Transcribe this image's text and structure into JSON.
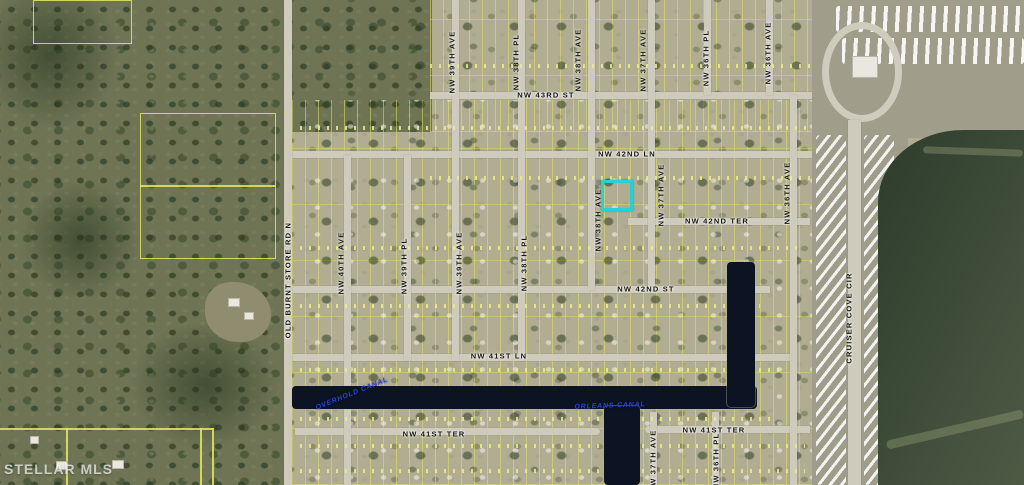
{
  "map": {
    "watermark": "STELLAR MLS",
    "highlighted_parcel": {
      "x": 601,
      "y": 180,
      "w": 32,
      "h": 31,
      "color": "#2bd0d6"
    },
    "labels": [
      {
        "text": "NW 43RD ST",
        "x": 546,
        "y": 95,
        "rot": 0,
        "kind": "street"
      },
      {
        "text": "NW 42ND LN",
        "x": 627,
        "y": 154,
        "rot": 0,
        "kind": "street"
      },
      {
        "text": "NW 42ND TER",
        "x": 717,
        "y": 221,
        "rot": 0,
        "kind": "street"
      },
      {
        "text": "NW 42ND ST",
        "x": 646,
        "y": 289,
        "rot": 0,
        "kind": "street"
      },
      {
        "text": "NW 41ST LN",
        "x": 499,
        "y": 356,
        "rot": 0,
        "kind": "street"
      },
      {
        "text": "NW 41ST TER",
        "x": 434,
        "y": 434,
        "rot": 0,
        "kind": "street"
      },
      {
        "text": "NW 41ST TER",
        "x": 714,
        "y": 430,
        "rot": 0,
        "kind": "street"
      },
      {
        "text": "OLD BURNT STORE RD N",
        "x": 288,
        "y": 280,
        "rot": -90,
        "kind": "street"
      },
      {
        "text": "NW 40TH AVE",
        "x": 341,
        "y": 263,
        "rot": -90,
        "kind": "street"
      },
      {
        "text": "NW 39TH PL",
        "x": 404,
        "y": 266,
        "rot": -90,
        "kind": "street"
      },
      {
        "text": "NW 39TH AVE",
        "x": 452,
        "y": 62,
        "rot": -90,
        "kind": "street"
      },
      {
        "text": "NW 39TH AVE",
        "x": 459,
        "y": 263,
        "rot": -90,
        "kind": "street"
      },
      {
        "text": "NW 38TH PL",
        "x": 516,
        "y": 62,
        "rot": -90,
        "kind": "street"
      },
      {
        "text": "NW 38TH PL",
        "x": 524,
        "y": 263,
        "rot": -90,
        "kind": "street"
      },
      {
        "text": "NW 38TH AVE",
        "x": 578,
        "y": 60,
        "rot": -90,
        "kind": "street"
      },
      {
        "text": "NW 38TH AVE",
        "x": 598,
        "y": 220,
        "rot": -90,
        "kind": "street"
      },
      {
        "text": "NW 37TH AVE",
        "x": 643,
        "y": 60,
        "rot": -90,
        "kind": "street"
      },
      {
        "text": "NW 37TH AVE",
        "x": 661,
        "y": 195,
        "rot": -90,
        "kind": "street"
      },
      {
        "text": "NW 37TH AVE",
        "x": 653,
        "y": 461,
        "rot": -90,
        "kind": "street"
      },
      {
        "text": "NW 36TH PL",
        "x": 706,
        "y": 58,
        "rot": -90,
        "kind": "street"
      },
      {
        "text": "NW 36TH PL",
        "x": 716,
        "y": 461,
        "rot": -90,
        "kind": "street"
      },
      {
        "text": "NW 36TH AVE",
        "x": 768,
        "y": 53,
        "rot": -90,
        "kind": "street"
      },
      {
        "text": "NW 36TH AVE",
        "x": 787,
        "y": 193,
        "rot": -90,
        "kind": "street"
      },
      {
        "text": "CRUISER COVE CIR",
        "x": 849,
        "y": 318,
        "rot": -90,
        "kind": "street"
      },
      {
        "text": "OVERHOLD CANAL",
        "x": 352,
        "y": 394,
        "rot": -22,
        "kind": "canal"
      },
      {
        "text": "ORLEANS CANAL",
        "x": 610,
        "y": 406,
        "rot": -2,
        "kind": "canal"
      }
    ],
    "colors": {
      "highlight": "#2bd0d6",
      "canal_text": "#2941e0",
      "canal_water": "#0c1322",
      "lake": "#3b4937",
      "parcel_line": "#e2e25c",
      "road": "#cfcbbc",
      "forest": "#6e7454",
      "developed": "#b1ad92"
    }
  }
}
